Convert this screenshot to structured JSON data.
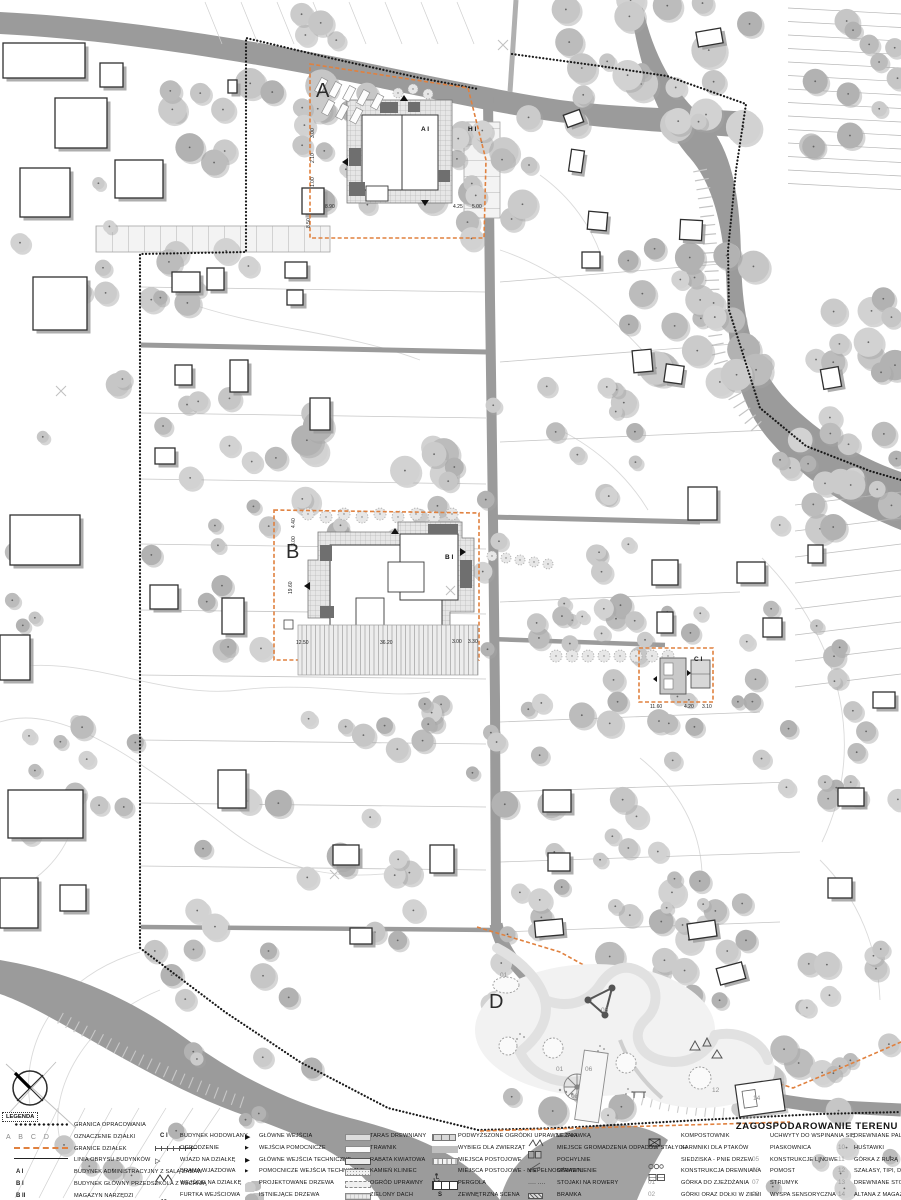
{
  "title": "ZAGOSPODAROWANIE TERENU",
  "legend": {
    "heading": "LEGENDA",
    "columns": [
      {
        "items": [
          {
            "sym": "dots",
            "label": "GRANICA OPRACOWANIA"
          },
          {
            "sym": "abcd",
            "code": "A B C D",
            "label": "OZNACZENIE DZIAŁKI"
          },
          {
            "sym": "dash-orange",
            "label": "GRANICE DZIAŁEK"
          },
          {
            "sym": "line",
            "label": "LINIA OBRYSU BUDYNKÓW"
          },
          {
            "sym": "code",
            "code": "A I",
            "label": "BUDYNEK ADMINISTRACYJNY Z SALĄ ZABAW"
          },
          {
            "sym": "code",
            "code": "B I",
            "label": "BUDYNEK GŁÓWNY PRZEDSZKOLA Z KUCHNIĄ"
          },
          {
            "sym": "code",
            "code": "B II",
            "label": "MAGAZYN NARZĘDZI"
          }
        ]
      },
      {
        "items": [
          {
            "sym": "code",
            "code": "C I",
            "label": "BUDYNEK HODOWLANY"
          },
          {
            "sym": "fence",
            "label": "OGRODZENIE"
          },
          {
            "sym": "tri-open",
            "label": "WJAZD NA DZIAŁKĘ"
          },
          {
            "sym": "gate",
            "label": "BRAMA WJAZDOWA"
          },
          {
            "sym": "tri-small",
            "label": "WEJŚCIE NA DZIAŁKĘ"
          },
          {
            "sym": "wicket",
            "label": "FURTKA WEJŚCIOWA"
          }
        ]
      },
      {
        "items": [
          {
            "sym": "arrow-lg",
            "label": "GŁÓWNE WEJŚCIA"
          },
          {
            "sym": "arrow-sm",
            "label": "WEJŚCIA POMOCNICZE"
          },
          {
            "sym": "arrow-tech",
            "label": "GŁÓWNE WEJŚCIA TECHNICZNE"
          },
          {
            "sym": "arrow-xs",
            "label": "POMOCNICZE WEJŚCIA TECHNICZNE"
          },
          {
            "sym": "trees-new",
            "label": "PROJEKTOWANE DRZEWA"
          },
          {
            "sym": "trees-old",
            "label": "ISTNIEJĄCE DRZEWA"
          }
        ]
      },
      {
        "items": [
          {
            "sym": "sw-taras",
            "label": "TARAS DREWNIANY"
          },
          {
            "sym": "sw-trawnik",
            "label": "TRAWNIK"
          },
          {
            "sym": "sw-rabata",
            "label": "RABATA KWIATOWA"
          },
          {
            "sym": "sw-kamien",
            "label": "KAMIEŃ KLINIEC"
          },
          {
            "sym": "sw-ogrod",
            "label": "OGRÓD UPRAWNY"
          },
          {
            "sym": "sw-dach",
            "label": "ZIELONY DACH"
          }
        ]
      },
      {
        "items": [
          {
            "sym": "sw-podw",
            "label": "PODWYŻSZONE OGRÓDKI UPRAWNE Z ŁAWKĄ"
          },
          {
            "sym": "sw-wybieg",
            "label": "WYBIEG DLA ZWIERZĄT"
          },
          {
            "sym": "sw-postoj",
            "label": "MIEJSCA POSTOJOWE"
          },
          {
            "sym": "nps",
            "label": "MIEJSCA POSTOJOWE - NIEPEŁNOSPRAWNI"
          },
          {
            "sym": "sw-pergola",
            "label": "PERGOLA"
          },
          {
            "sym": "code",
            "code": "S",
            "label": "ZEWNĘTRZNA SCENA"
          }
        ]
      },
      {
        "items": [
          {
            "sym": "lezaki",
            "label": "LEŻAKI"
          },
          {
            "sym": "odpady",
            "label": "MIEJSCE GROMADZENIA ODPADÓW STAŁYCH"
          },
          {
            "sym": "pochylnia",
            "label": "POCHYLNIE"
          },
          {
            "sym": "oswietlenie",
            "label": "OŚWIETLENIE"
          },
          {
            "sym": "stojaki",
            "label": "STOJAKI NA ROWERY"
          },
          {
            "sym": "bramka",
            "label": "BRAMKA"
          }
        ]
      },
      {
        "items": [
          {
            "sym": "kompost",
            "label": "KOMPOSTOWNIK"
          },
          {
            "sym": "karmniki",
            "label": "KARMNIKI DLA PTAKÓW"
          },
          {
            "sym": "siedziska",
            "label": "SIEDZISKA - PNIE DRZEW"
          },
          {
            "sym": "konstrukcja",
            "label": "KONSTRUKCJA DREWNIANA"
          },
          {
            "sym": "num",
            "code": "01",
            "label": "GÓRKA DO ZJEŻDŻANIA"
          },
          {
            "sym": "num",
            "code": "02",
            "label": "GÓRKI ORAZ DOŁKI W ZIEMI"
          }
        ]
      },
      {
        "items": [
          {
            "sym": "none",
            "label": "UCHWYTY DO WSPINANIA SIĘ"
          },
          {
            "sym": "none",
            "label": "PIASKOWNICA"
          },
          {
            "sym": "num",
            "code": "05",
            "label": "KONSTRUKCJE LINOWE"
          },
          {
            "sym": "num",
            "code": "06",
            "label": "POMOST"
          },
          {
            "sym": "num",
            "code": "07",
            "label": "STRUMYK"
          },
          {
            "sym": "num",
            "code": "08",
            "label": "WYSPA SENSORYCZNA"
          }
        ]
      },
      {
        "items": [
          {
            "sym": "none",
            "label": "DREWNIANE PALE"
          },
          {
            "sym": "num",
            "code": "10",
            "label": "HUŚTAWKI"
          },
          {
            "sym": "num",
            "code": "11",
            "label": "GÓRKA Z RURĄ"
          },
          {
            "sym": "num",
            "code": "12",
            "label": "SZAŁASY, TIPI, DOMKI"
          },
          {
            "sym": "num",
            "code": "13",
            "label": "DREWNIANE STOŁECZKI"
          },
          {
            "sym": "num",
            "code": "14",
            "label": "ALTANA Z MAGAZYNEM"
          }
        ]
      }
    ]
  },
  "map": {
    "area_labels": [
      {
        "text": "A",
        "x": 316,
        "y": 97
      },
      {
        "text": "B",
        "x": 286,
        "y": 558
      },
      {
        "text": "D",
        "x": 489,
        "y": 1008
      }
    ],
    "building_labels": [
      {
        "text": "A I",
        "x": 421,
        "y": 131
      },
      {
        "text": "H I",
        "x": 468,
        "y": 131
      },
      {
        "text": "B I",
        "x": 445,
        "y": 559
      },
      {
        "text": "C I",
        "x": 694,
        "y": 661
      }
    ],
    "dimensions": [
      {
        "text": "8.50",
        "x": 310,
        "y": 228,
        "rot": -90
      },
      {
        "text": "3.00",
        "x": 314,
        "y": 138,
        "rot": -90
      },
      {
        "text": "2.10",
        "x": 314,
        "y": 163,
        "rot": -90
      },
      {
        "text": "1.00",
        "x": 314,
        "y": 187,
        "rot": -90
      },
      {
        "text": "8.90",
        "x": 325,
        "y": 208,
        "rot": 0
      },
      {
        "text": "4.25",
        "x": 453,
        "y": 208,
        "rot": 0
      },
      {
        "text": "5.00",
        "x": 472,
        "y": 208,
        "rot": 0
      },
      {
        "text": "4.40",
        "x": 295,
        "y": 528,
        "rot": -90
      },
      {
        "text": "3.00",
        "x": 295,
        "y": 546,
        "rot": -90
      },
      {
        "text": "19.60",
        "x": 292,
        "y": 594,
        "rot": -90
      },
      {
        "text": "12.50",
        "x": 296,
        "y": 644,
        "rot": 0
      },
      {
        "text": "36.20",
        "x": 380,
        "y": 644,
        "rot": 0
      },
      {
        "text": "3.00",
        "x": 452,
        "y": 643,
        "rot": 0
      },
      {
        "text": "3.30",
        "x": 468,
        "y": 643,
        "rot": 0
      },
      {
        "text": "11.60",
        "x": 650,
        "y": 708,
        "rot": 0
      },
      {
        "text": "4.20",
        "x": 684,
        "y": 708,
        "rot": 0
      },
      {
        "text": "3.10",
        "x": 702,
        "y": 708,
        "rot": 0
      }
    ],
    "playground_numbers": [
      {
        "text": "01",
        "x": 500,
        "y": 977
      },
      {
        "text": "05",
        "x": 601,
        "y": 1012
      },
      {
        "text": "01",
        "x": 556,
        "y": 1071
      },
      {
        "text": "06",
        "x": 585,
        "y": 1071
      },
      {
        "text": "08",
        "x": 571,
        "y": 1098
      },
      {
        "text": "12",
        "x": 712,
        "y": 1092
      },
      {
        "text": "14",
        "x": 753,
        "y": 1100
      }
    ],
    "colors": {
      "parcel_orange": "#E0813F",
      "road_gray": "#9B9B9B",
      "tree_gray": "#BDBDBD",
      "ink": "#1A1A1A"
    }
  }
}
